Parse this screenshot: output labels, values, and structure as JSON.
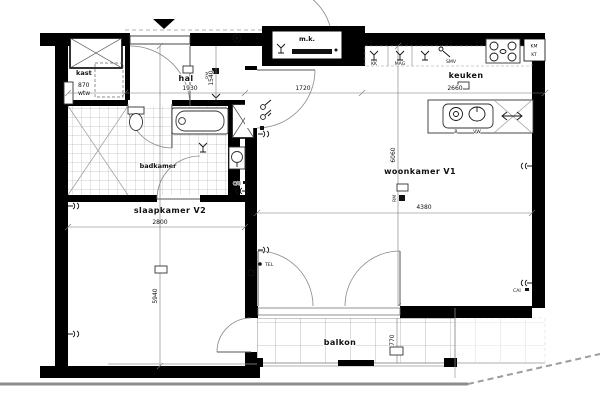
{
  "rooms": {
    "hal": {
      "label": "hal",
      "width": "1930",
      "height": "1540"
    },
    "kast": {
      "label": "kast",
      "dim": "870",
      "unit": "wtw"
    },
    "mk": {
      "label": "m.k.",
      "span": "1720"
    },
    "keuken": {
      "label": "keuken",
      "width": "2660"
    },
    "badkamer": {
      "label": "badkamer"
    },
    "slaapkamer": {
      "label": "slaapkamer V2",
      "width": "2800",
      "height": "5940"
    },
    "woonkamer": {
      "label": "woonkamer V1",
      "width": "4380",
      "height": "6060"
    },
    "balkon": {
      "label": "balkon",
      "depth": "1770"
    }
  },
  "outlets": {
    "tel": "TEL",
    "cai": "CAI",
    "rm": "RM"
  },
  "kitchen": {
    "kk": "KK",
    "mag": "MAG",
    "smv": "SMV",
    "km": "KM",
    "kt": "KT",
    "b": "B",
    "vw": "VW"
  },
  "colors": {
    "wall": "#000000",
    "line": "#888888",
    "background": "#ffffff"
  }
}
